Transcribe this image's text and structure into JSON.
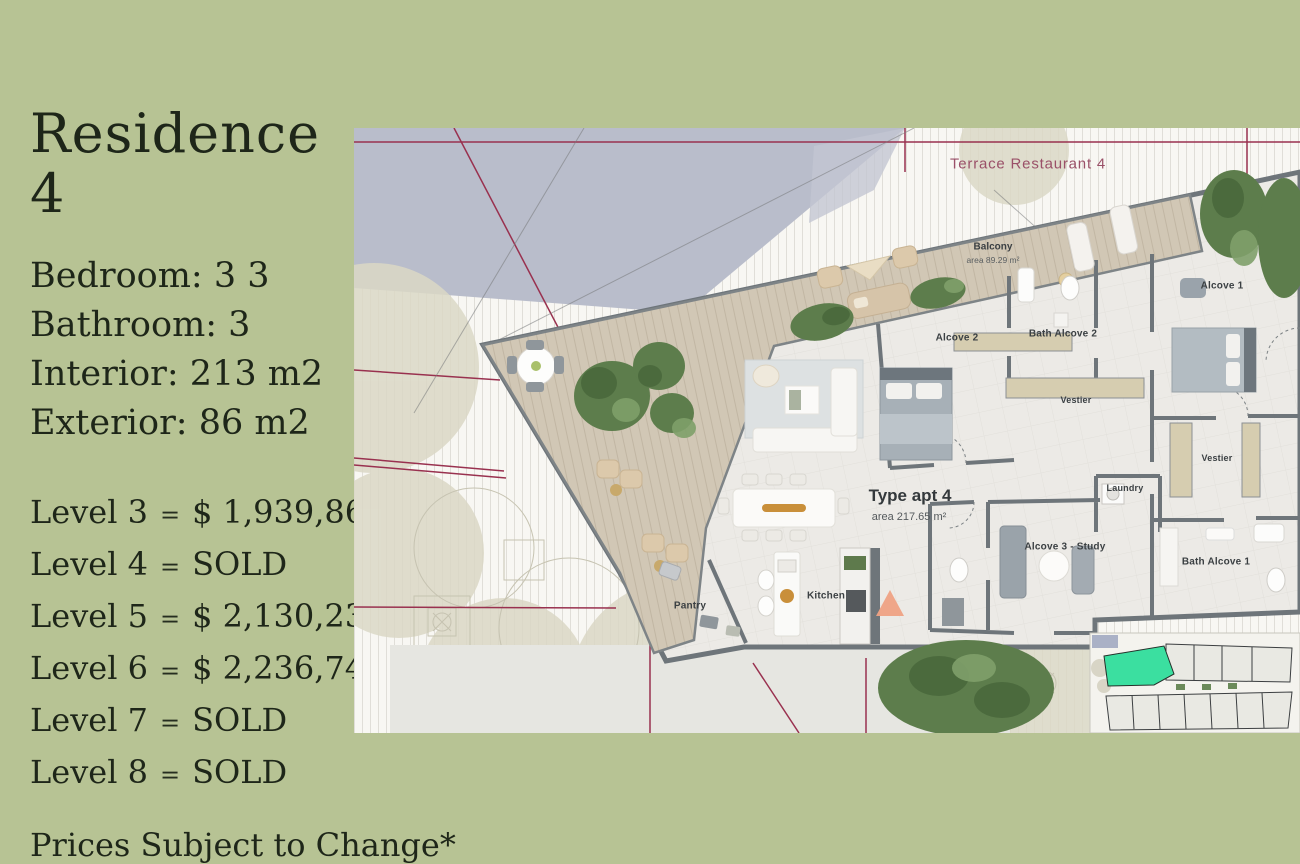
{
  "colors": {
    "background": "#b7c394",
    "text": "#1e2619",
    "terrace_label": "#9a5068",
    "site_lines": "#99314f",
    "walls": "#6e757a",
    "unit_highlight": "#3bdfa0"
  },
  "info": {
    "title": "Residence 4",
    "specs": [
      "Bedroom: 3 3",
      "Bathroom: 3",
      "Interior: 213 m2",
      "Exterior: 86 m2"
    ],
    "levels": [
      {
        "label": "Level 3",
        "sep": "=",
        "value": "$ 1,939,860"
      },
      {
        "label": "Level 4",
        "sep": "=",
        "value": "SOLD"
      },
      {
        "label": "Level 5",
        "sep": "=",
        "value": "$ 2,130,235"
      },
      {
        "label": "Level 6",
        "sep": "=",
        "value": "$ 2,236,747"
      },
      {
        "label": "Level 7",
        "sep": "=",
        "value": "SOLD"
      },
      {
        "label": "Level 8",
        "sep": "=",
        "value": "SOLD"
      }
    ],
    "disclaimer": "Prices Subject to Change*"
  },
  "plan": {
    "terrace_title": "Terrace Restaurant 4",
    "apartment_name": "Type apt 4",
    "apartment_area": "area 217.65 m²",
    "balcony_name": "Balcony",
    "balcony_area": "area 89.29 m²",
    "rooms": [
      {
        "label": "Alcove 1"
      },
      {
        "label": "Alcove 2"
      },
      {
        "label": "Bath Alcove 2"
      },
      {
        "label": "Vestier"
      },
      {
        "label": "Vestier"
      },
      {
        "label": "Laundry"
      },
      {
        "label": "Alcove 3 - Study"
      },
      {
        "label": "Bath Alcove 1"
      },
      {
        "label": "Kitchen"
      },
      {
        "label": "Pantry"
      }
    ]
  }
}
